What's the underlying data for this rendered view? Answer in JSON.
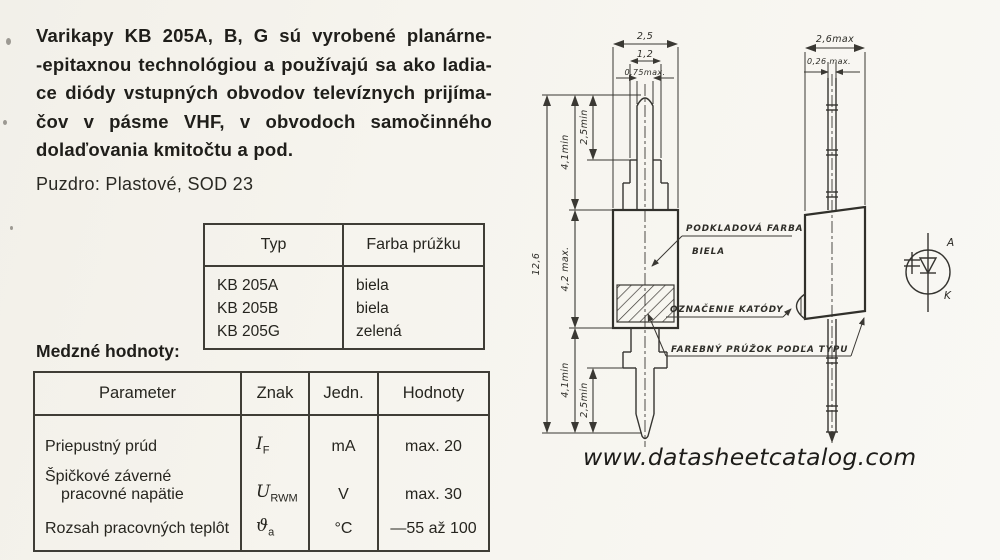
{
  "colors": {
    "paper": "#f5f3ee",
    "ink": "#26251f",
    "line": "#3a3833"
  },
  "intro": {
    "lines": [
      "Varikapy KB 205A, B, G sú vyrobené planárne-",
      "-epitaxnou technológiou a používajú sa ako ladia-",
      "ce diódy vstupných obvodov televíznych prijíma-",
      "čov v pásme VHF, v obvodoch samočinného",
      "dolaďovania kmitočtu a pod."
    ]
  },
  "package_line": "Puzdro: Plastové, SOD 23",
  "type_table": {
    "headers": [
      "Typ",
      "Farba prúžku"
    ],
    "rows": [
      [
        "KB 205A",
        "biela"
      ],
      [
        "KB 205B",
        "biela"
      ],
      [
        "KB 205G",
        "zelená"
      ]
    ]
  },
  "limits": {
    "heading": "Medzné hodnoty:",
    "headers": [
      "Parameter",
      "Znak",
      "Jedn.",
      "Hodnoty"
    ],
    "rows": [
      {
        "p1": "Priepustný prúd",
        "p2": "",
        "sym": "I",
        "sub": "F",
        "unit": "mA",
        "val": "max. 20"
      },
      {
        "p1": "Špičkové záverné",
        "p2": "pracovné napätie",
        "sym": "U",
        "sub": "RWM",
        "unit": "V",
        "val": "max. 30"
      },
      {
        "p1": "Rozsah pracovných teplôt",
        "p2": "",
        "sym": "ϑ",
        "sub": "a",
        "unit": "°C",
        "val": "—55 až 100"
      }
    ]
  },
  "drawing": {
    "front": {
      "w_outer": "2,5",
      "w_mid": "1,2",
      "w_pin": "0,75max.",
      "overall": "12,6",
      "lead_top": "4,1min",
      "lead_top_inner": "2,5min",
      "body": "4,2 max.",
      "lead_bot": "4,1min",
      "lead_bot_inner": "2,5min"
    },
    "side": {
      "w": "2,6max",
      "lead": "0,26 max."
    },
    "callouts": {
      "base1": "PODKLADOVÁ FARBA",
      "base2": "BIELA",
      "cathode": "OZNAČENIE KATÓDY",
      "stripe": "FAREBNÝ PRÚŽOK PODĽA TYPU"
    },
    "symbol": {
      "a": "A",
      "k": "K"
    }
  },
  "watermark": "www.datasheetcatalog.com"
}
